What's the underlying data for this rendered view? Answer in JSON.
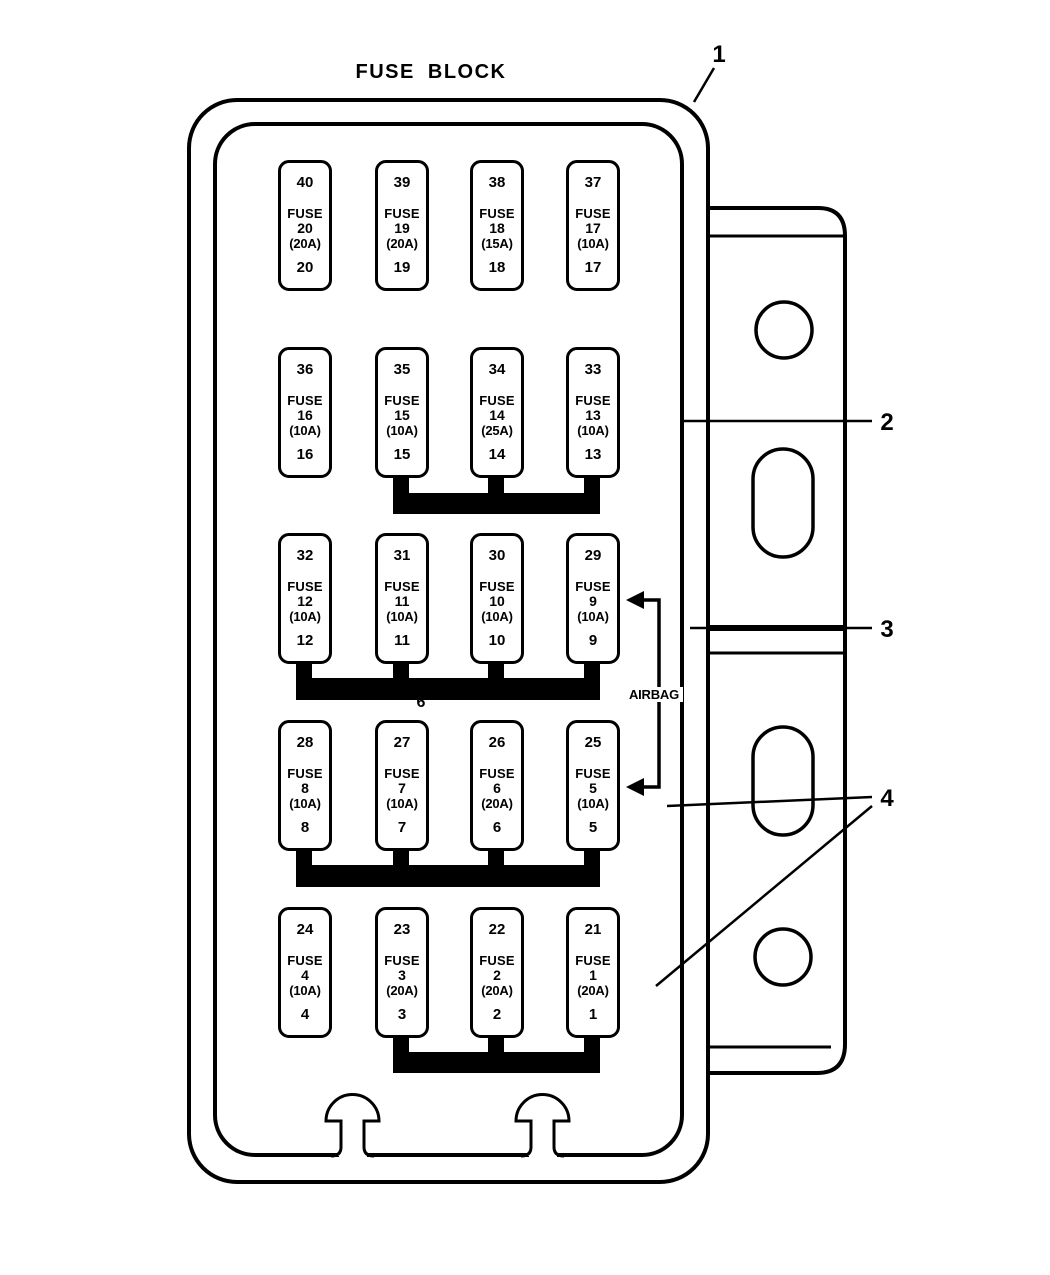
{
  "title": "FUSE BLOCK",
  "labels": {
    "airbag": "AIRBAG",
    "connector6": "6"
  },
  "callouts": {
    "one": "1",
    "two": "2",
    "three": "3",
    "four": "4"
  },
  "fuses": [
    {
      "cavity": "40",
      "label": "FUSE",
      "number": "20",
      "amps": "(20A)",
      "position": "20"
    },
    {
      "cavity": "39",
      "label": "FUSE",
      "number": "19",
      "amps": "(20A)",
      "position": "19"
    },
    {
      "cavity": "38",
      "label": "FUSE",
      "number": "18",
      "amps": "(15A)",
      "position": "18"
    },
    {
      "cavity": "37",
      "label": "FUSE",
      "number": "17",
      "amps": "(10A)",
      "position": "17"
    },
    {
      "cavity": "36",
      "label": "FUSE",
      "number": "16",
      "amps": "(10A)",
      "position": "16"
    },
    {
      "cavity": "35",
      "label": "FUSE",
      "number": "15",
      "amps": "(10A)",
      "position": "15"
    },
    {
      "cavity": "34",
      "label": "FUSE",
      "number": "14",
      "amps": "(25A)",
      "position": "14"
    },
    {
      "cavity": "33",
      "label": "FUSE",
      "number": "13",
      "amps": "(10A)",
      "position": "13"
    },
    {
      "cavity": "32",
      "label": "FUSE",
      "number": "12",
      "amps": "(10A)",
      "position": "12"
    },
    {
      "cavity": "31",
      "label": "FUSE",
      "number": "11",
      "amps": "(10A)",
      "position": "11"
    },
    {
      "cavity": "30",
      "label": "FUSE",
      "number": "10",
      "amps": "(10A)",
      "position": "10"
    },
    {
      "cavity": "29",
      "label": "FUSE",
      "number": "9",
      "amps": "(10A)",
      "position": "9"
    },
    {
      "cavity": "28",
      "label": "FUSE",
      "number": "8",
      "amps": "(10A)",
      "position": "8"
    },
    {
      "cavity": "27",
      "label": "FUSE",
      "number": "7",
      "amps": "(10A)",
      "position": "7"
    },
    {
      "cavity": "26",
      "label": "FUSE",
      "number": "6",
      "amps": "(20A)",
      "position": "6"
    },
    {
      "cavity": "25",
      "label": "FUSE",
      "number": "5",
      "amps": "(10A)",
      "position": "5"
    },
    {
      "cavity": "24",
      "label": "FUSE",
      "number": "4",
      "amps": "(10A)",
      "position": "4"
    },
    {
      "cavity": "23",
      "label": "FUSE",
      "number": "3",
      "amps": "(20A)",
      "position": "3"
    },
    {
      "cavity": "22",
      "label": "FUSE",
      "number": "2",
      "amps": "(20A)",
      "position": "2"
    },
    {
      "cavity": "21",
      "label": "FUSE",
      "number": "1",
      "amps": "(20A)",
      "position": "1"
    }
  ]
}
